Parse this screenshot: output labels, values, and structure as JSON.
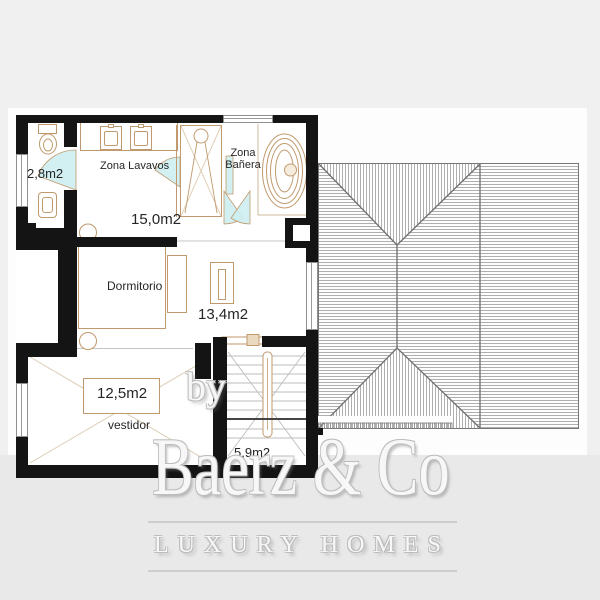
{
  "document": {
    "type": "floor-plan",
    "floor": "upper"
  },
  "labels": {
    "wc_area": "2,8m2",
    "washbasin_zone": "Zona Lavavos",
    "bath_zone": {
      "line1": "Zona",
      "line2": "Bañera"
    },
    "bathroom_area": "15,0m2",
    "bedroom_name": "Dormitorio",
    "bedroom_area": "13,4m2",
    "dressing_area": "12,5m2",
    "dressing_name": "vestidor",
    "stairs_area": "5,9m2"
  },
  "watermark": {
    "prefix": "by",
    "brand": "Baerz & Co",
    "tagline": "LUXURY HOMES"
  },
  "colors": {
    "bg": "#f0f0f0",
    "canvas": "#fdfdfd",
    "band": "#e9e9e9",
    "wall": "#141414",
    "fixture": "#c09a6e",
    "fixture-light": "#dccdb2",
    "door": "#cdeef0",
    "roof-line": "#8f8f8f",
    "roof-dark": "#707070",
    "plan-text": "#262626",
    "watermark-edge": "#bdbdbd"
  }
}
